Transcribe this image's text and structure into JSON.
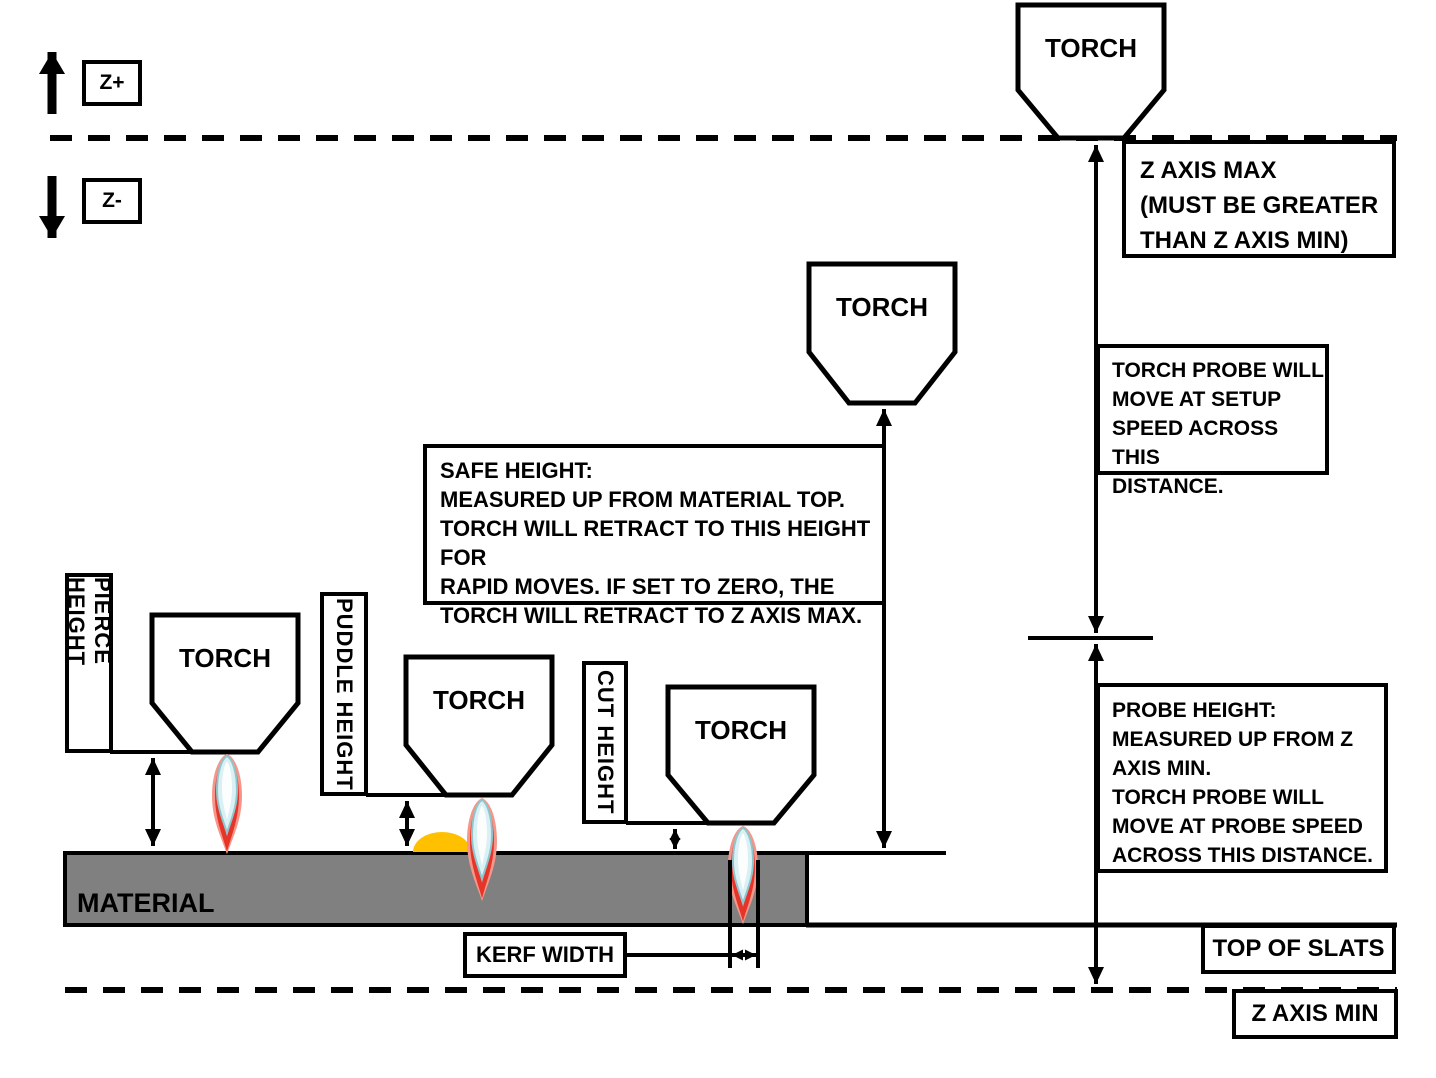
{
  "labels": {
    "z_plus": "Z+",
    "z_minus": "Z-",
    "torch": "TORCH",
    "pierce_height": "PIERCE HEIGHT",
    "puddle_height": "PUDDLE HEIGHT",
    "cut_height": "CUT HEIGHT",
    "material": "MATERIAL",
    "kerf_width": "KERF WIDTH",
    "top_of_slats": "TOP OF SLATS",
    "z_axis_min": "Z AXIS MIN"
  },
  "callouts": {
    "z_axis_max": "Z AXIS MAX\n(MUST BE GREATER\nTHAN Z AXIS MIN)",
    "torch_probe": "TORCH PROBE WILL\nMOVE AT SETUP\nSPEED ACROSS THIS\nDISTANCE.",
    "safe_height": "SAFE HEIGHT:\nMEASURED UP FROM MATERIAL TOP.\nTORCH WILL RETRACT TO THIS HEIGHT FOR\nRAPID MOVES.  IF SET TO ZERO, THE\nTORCH WILL RETRACT TO Z AXIS MAX.",
    "probe_height": "PROBE HEIGHT:\nMEASURED UP FROM Z\nAXIS MIN.\nTORCH PROBE WILL\nMOVE AT PROBE SPEED\nACROSS THIS DISTANCE."
  },
  "colors": {
    "line": "#000000",
    "material_gray": "#808080",
    "flame_glow": "#f6968a",
    "flame_red": "#e63528",
    "flame_cyan": "#d9f0f4",
    "flame_cyan_edge": "#8fc6cd",
    "puddle_orange": "#ffc000"
  }
}
